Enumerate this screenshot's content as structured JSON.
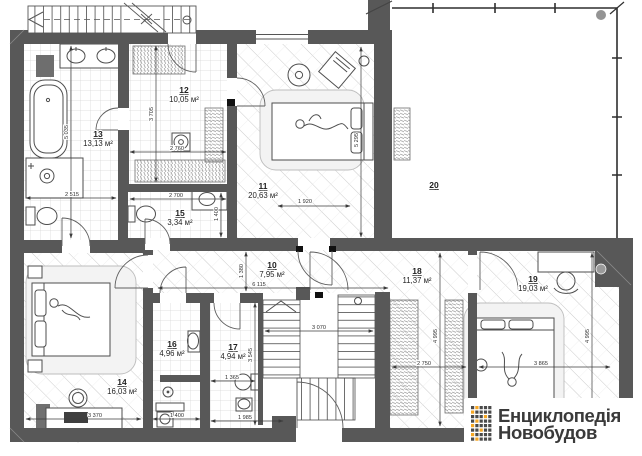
{
  "rooms": [
    {
      "number": "10",
      "area": "7,95 м²"
    },
    {
      "number": "11",
      "area": "20,63 м²"
    },
    {
      "number": "12",
      "area": "10,05 м²"
    },
    {
      "number": "13",
      "area": "13,13 м²"
    },
    {
      "number": "14",
      "area": "16,03 м²"
    },
    {
      "number": "15",
      "area": "3,34 м²"
    },
    {
      "number": "16",
      "area": "4,96 м²"
    },
    {
      "number": "17",
      "area": "4,94 м²"
    },
    {
      "number": "18",
      "area": "11,37 м²"
    },
    {
      "number": "19",
      "area": "19,03 м²"
    },
    {
      "number": "20",
      "area": ""
    }
  ],
  "dimensions": [
    {
      "text": "5 035"
    },
    {
      "text": "2 515"
    },
    {
      "text": "3 705"
    },
    {
      "text": "2 760"
    },
    {
      "text": "2 700"
    },
    {
      "text": "1 400"
    },
    {
      "text": "5 295"
    },
    {
      "text": "1 920"
    },
    {
      "text": "1 380"
    },
    {
      "text": "6 115"
    },
    {
      "text": "3 070"
    },
    {
      "text": "3 545"
    },
    {
      "text": "1 365"
    },
    {
      "text": "1 985"
    },
    {
      "text": "1 400"
    },
    {
      "text": "3 370"
    },
    {
      "text": "4 995"
    },
    {
      "text": "4 995"
    },
    {
      "text": "2 750"
    },
    {
      "text": "3 865"
    }
  ],
  "watermark": {
    "line1": "Енциклопедія",
    "line2": "Новобудов"
  },
  "colors": {
    "wall": "#585858",
    "accent_orange": "#f5a623",
    "logo_text": "#3a3a3a",
    "dim_text": "#2e2e2e"
  }
}
